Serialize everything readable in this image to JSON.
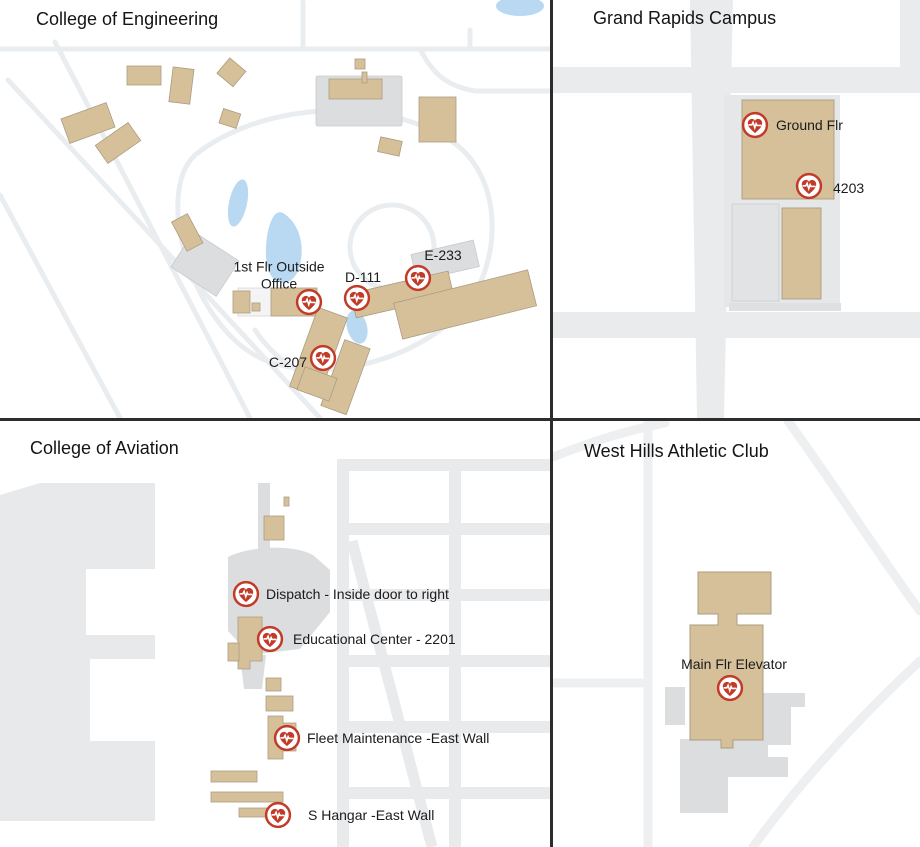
{
  "colors": {
    "marker_red": "#c23b28",
    "building_tan": "#d5c09a",
    "building_gray": "#dcdddf",
    "road_gray": "#e9ebed",
    "water_blue": "#b9d9f2",
    "divider_dark": "#2d2d2d"
  },
  "quadrants": {
    "engineering": {
      "title": "College of Engineering",
      "markers": [
        {
          "label": "1st Flr Outside Office"
        },
        {
          "label": "D-111"
        },
        {
          "label": "E-233"
        },
        {
          "label": "C-207"
        }
      ]
    },
    "grand_rapids": {
      "title": "Grand Rapids Campus",
      "markers": [
        {
          "label": "Ground Flr"
        },
        {
          "label": "4203"
        }
      ]
    },
    "aviation": {
      "title": "College of Aviation",
      "markers": [
        {
          "label": "Dispatch - Inside door to right"
        },
        {
          "label": "Educational Center - 2201"
        },
        {
          "label": "Fleet Maintenance -East Wall"
        },
        {
          "label": "S Hangar -East Wall"
        }
      ]
    },
    "west_hills": {
      "title": "West Hills Athletic Club",
      "markers": [
        {
          "label": "Main Flr Elevator"
        }
      ]
    }
  }
}
